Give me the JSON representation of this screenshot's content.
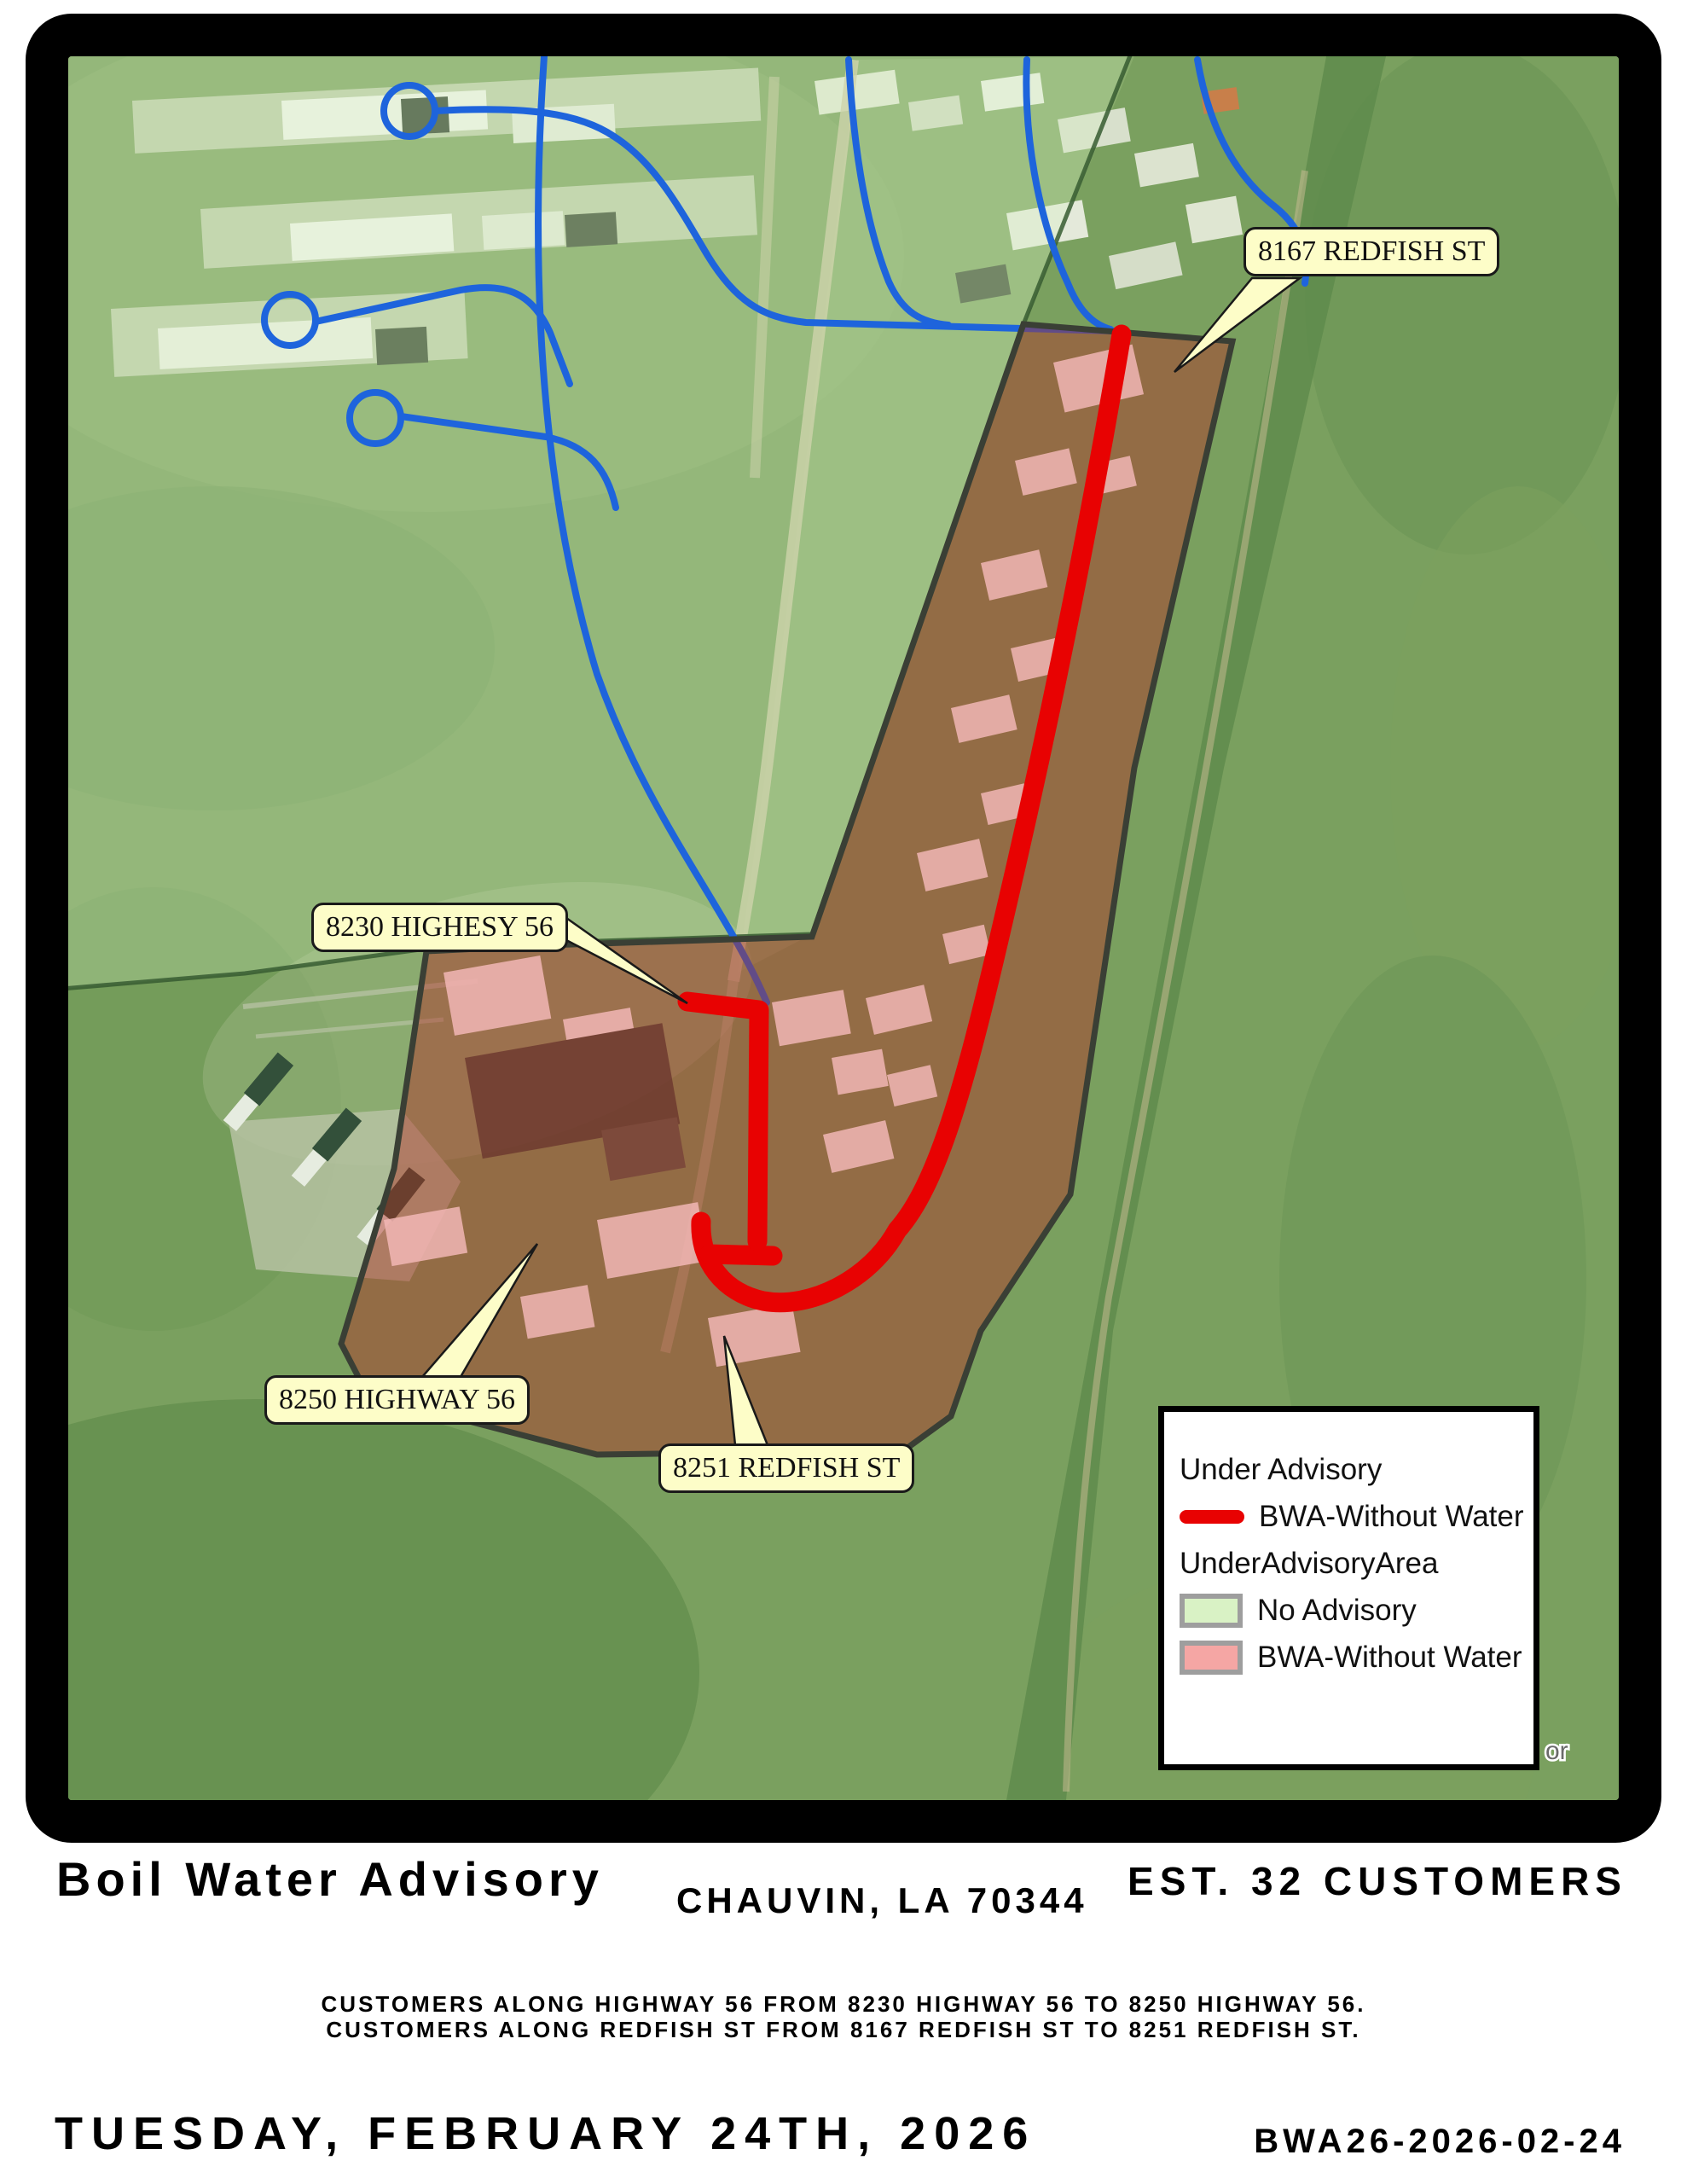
{
  "map": {
    "callouts": [
      {
        "id": "redfish-8167",
        "text": "8167 REDFISH ST"
      },
      {
        "id": "highway-8230",
        "text": "8230 HIGHESY 56"
      },
      {
        "id": "highway-8250",
        "text": "8250 HIGHWAY 56"
      },
      {
        "id": "redfish-8251",
        "text": "8251 REDFISH ST"
      }
    ],
    "legend": {
      "header": "Under Advisory",
      "line_label": "BWA-Without Water",
      "group_title": "UnderAdvisoryArea",
      "no_advisory_label": "No Advisory",
      "area_label": "BWA-Without Water"
    },
    "attribution_fragment": "or"
  },
  "footer": {
    "title": "Boil Water Advisory",
    "city": "CHAUVIN, LA 70344",
    "customers": "EST. 32 CUSTOMERS",
    "description_lines": [
      "CUSTOMERS ALONG HIGHWAY 56 FROM 8230 HIGHWAY 56 TO 8250 HIGHWAY 56.",
      "CUSTOMERS ALONG REDFISH ST FROM 8167 REDFISH ST TO 8251 REDFISH ST."
    ],
    "date": "TUESDAY, FEBRUARY 24TH, 2026",
    "advisory_id": "BWA26-2026-02-24"
  },
  "colors": {
    "route_red": "#e80202",
    "advisory_area_fill": "#b03028",
    "no_advisory_fill": "#d9f2c5",
    "bwa_swatch_fill": "#f5a6a4",
    "water_line_blue": "#1e64dc",
    "callout_bg": "#fdfdc8"
  }
}
